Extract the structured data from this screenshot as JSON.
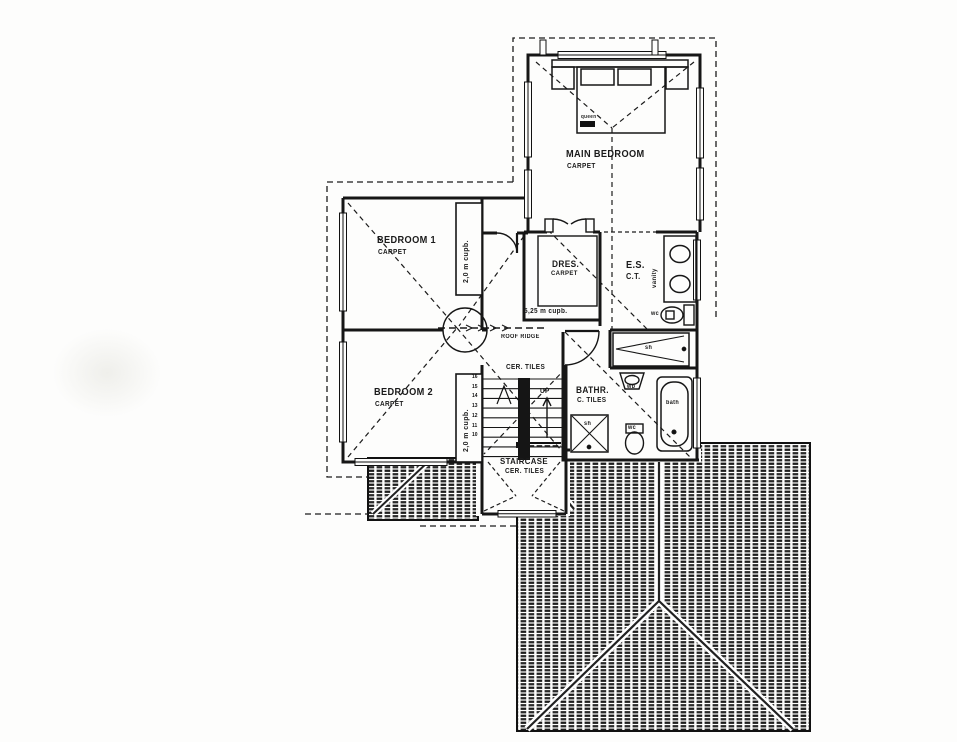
{
  "drawing": {
    "rooms": {
      "main_bedroom": {
        "name": "MAIN BEDROOM",
        "finish": "CARPET",
        "bed_label": "queen"
      },
      "bedroom1": {
        "name": "BEDROOM 1",
        "finish": "CARPET"
      },
      "bedroom2": {
        "name": "BEDROOM 2",
        "finish": "CARPET"
      },
      "dressing": {
        "name": "DRES.",
        "finish": "CARPET",
        "cupboard": "5,25 m cupb."
      },
      "ensuite": {
        "name": "E.S.",
        "finish": "C.T."
      },
      "bathroom": {
        "name": "BATHR.",
        "finish": "C. TILES"
      },
      "staircase": {
        "name": "STAIRCASE",
        "finish": "CER. TILES"
      }
    },
    "labels": {
      "cupboard_bedroom1": "2,0 m cupb.",
      "cupboard_bedroom2": "2,0 m cupb.",
      "landing_finish": "CER. TILES",
      "roof_ridge": "ROOF RIDGE",
      "up": "UP"
    },
    "fixtures": {
      "vanity": "vanity",
      "wc_ensuite": "wc",
      "shower_ensuite": "sh",
      "shower_bathroom": "sh",
      "basin": "wb",
      "wc_bathroom": "wc",
      "bath": "bath"
    },
    "stairs": {
      "numbers": [
        "16",
        "15",
        "14",
        "13",
        "12",
        "11",
        "10"
      ]
    },
    "colors": {
      "line": "#1a1a1a",
      "background": "#fdfdfc"
    }
  }
}
